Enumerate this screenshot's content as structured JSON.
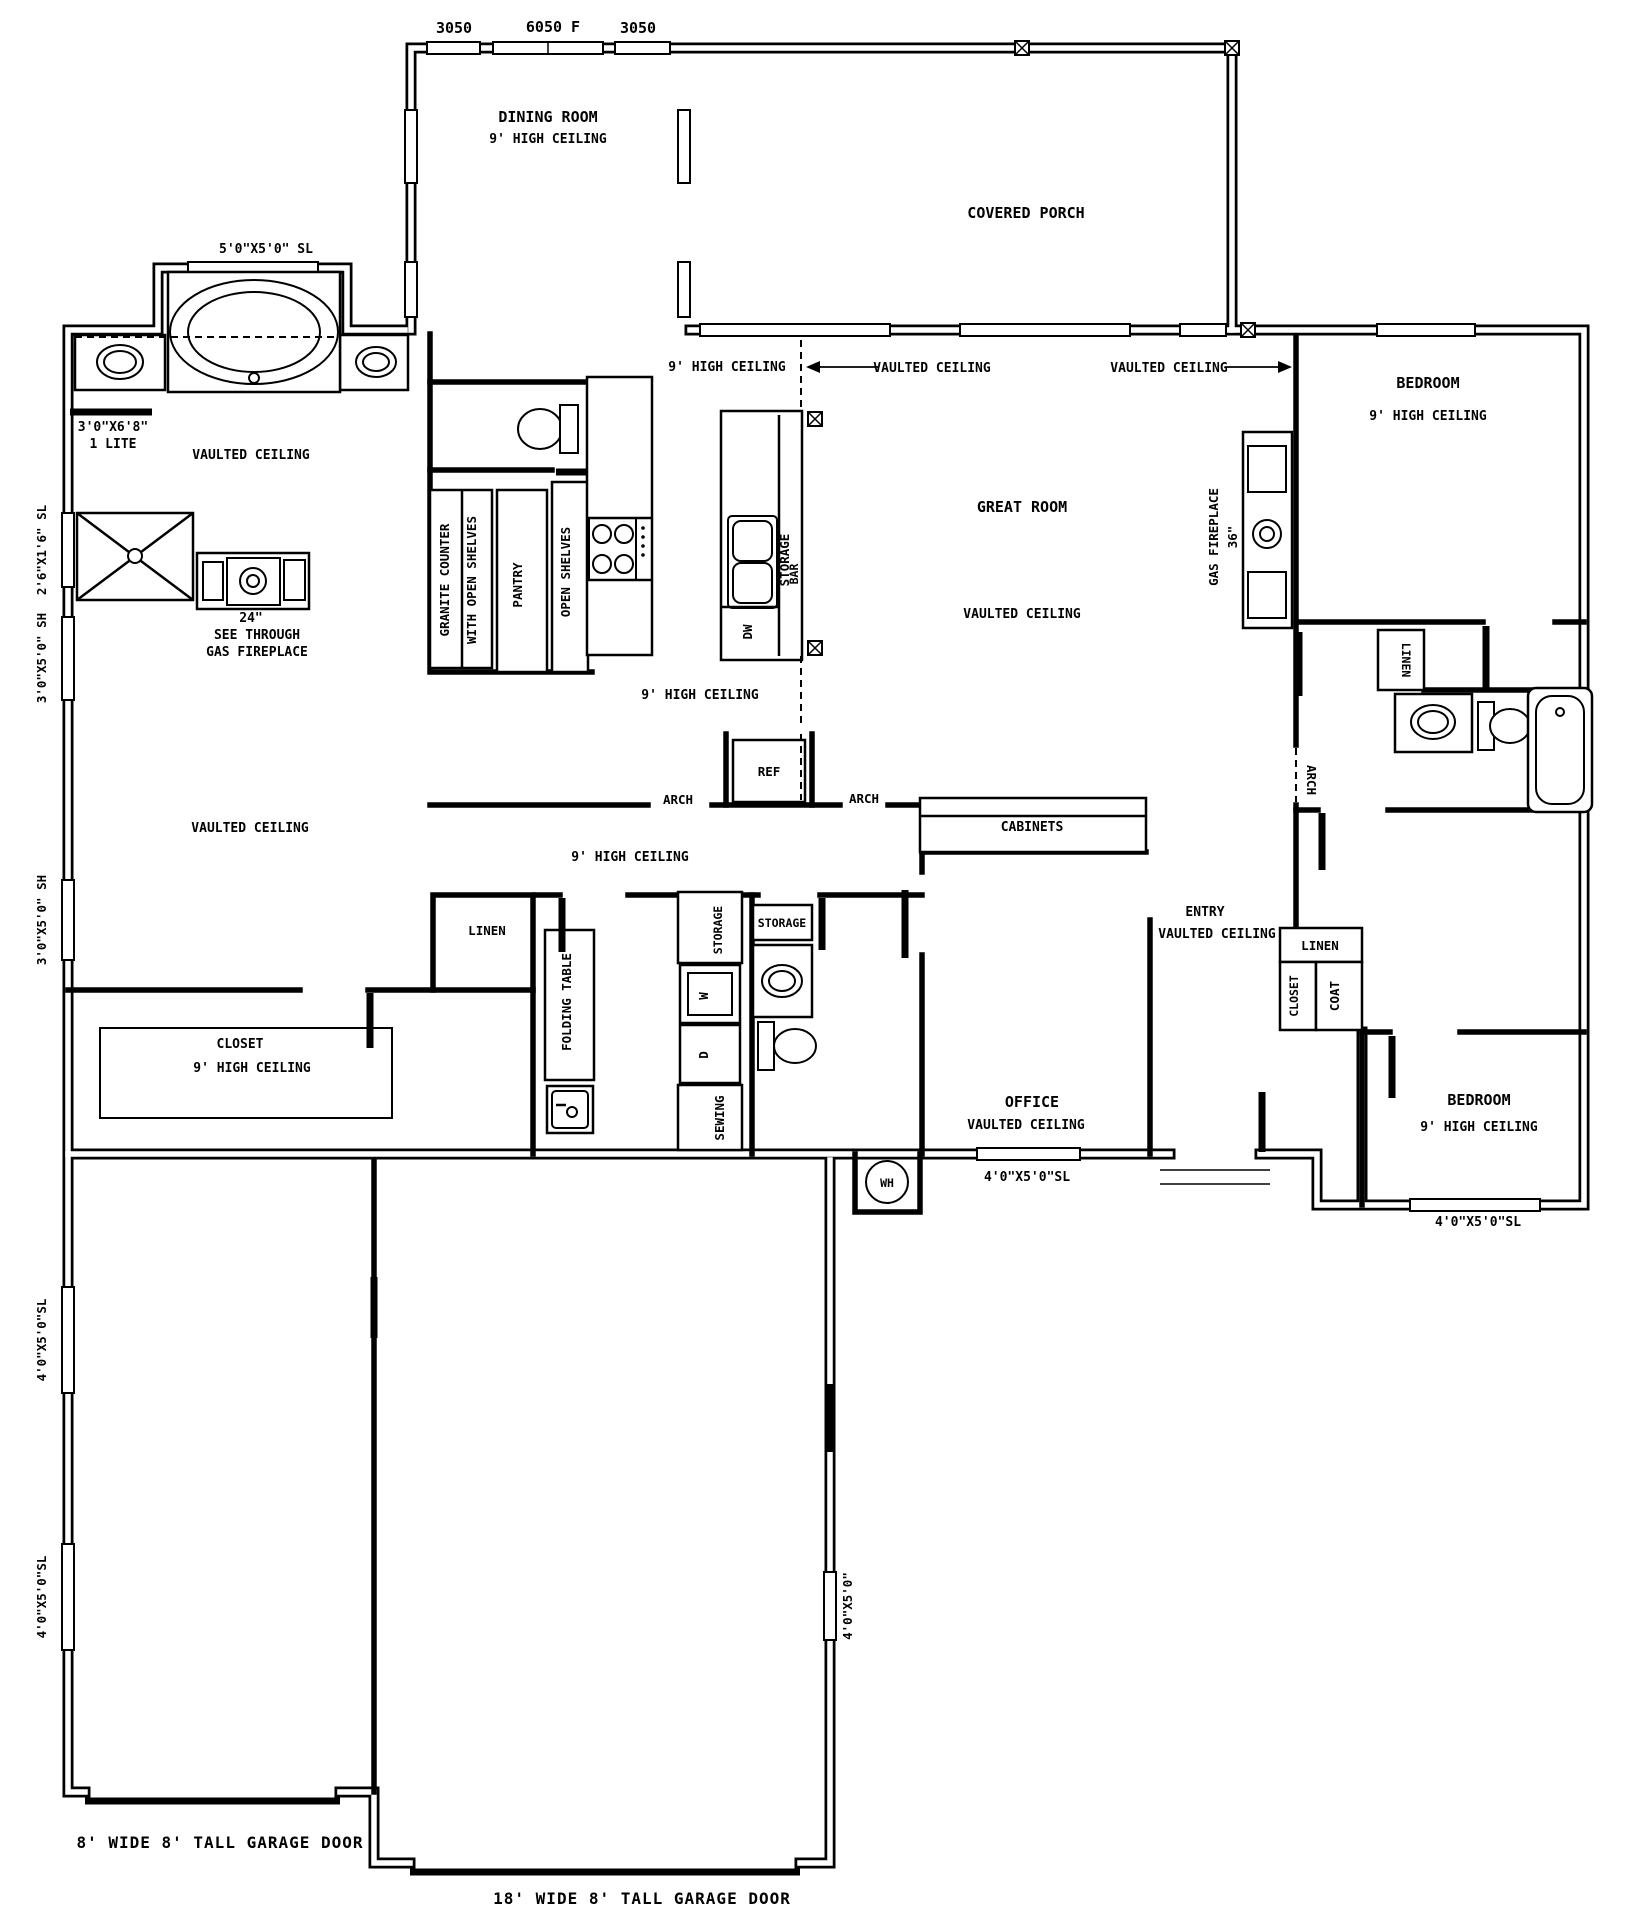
{
  "colors": {
    "line": "#000000",
    "background": "#ffffff"
  },
  "dims": {
    "left": "3050",
    "center": "6050 F",
    "right": "3050"
  },
  "dining": {
    "name": "DINING ROOM",
    "ceiling": "9' HIGH CEILING"
  },
  "porch": {
    "name": "COVERED PORCH"
  },
  "ceiling_notes": {
    "nine_main": "9' HIGH CEILING",
    "vaulted_left": "VAULTED CEILING",
    "vaulted_right": "VAULTED CEILING"
  },
  "master": {
    "window_top": "5'0\"X5'0\" SL",
    "door": "3'0\"X6'8\"",
    "door_lite": "1 LITE",
    "vaulted_bath": "VAULTED CEILING",
    "vaulted_bed": "VAULTED CEILING",
    "win_shower": "2'6\"X1'6\" SL",
    "win_sh1": "3'0\"X5'0\" SH",
    "win_sh2": "3'0\"X5'0\" SH",
    "fp_size": "24\"",
    "fp_line1": "SEE THROUGH",
    "fp_line2": "GAS FIREPLACE"
  },
  "kitchen": {
    "granite": "GRANITE COUNTER",
    "granite2": "WITH OPEN SHELVES",
    "pantry": "PANTRY",
    "open_shelves": "OPEN SHELVES",
    "ceiling": "9' HIGH CEILING",
    "island_storage": "STORAGE",
    "island_bar": "BAR",
    "dw": "DW",
    "ref": "REF",
    "arch_left": "ARCH",
    "arch_right": "ARCH"
  },
  "great_room": {
    "name": "GREAT ROOM",
    "vaulted": "VAULTED CEILING",
    "fp": "GAS FIREPLACE",
    "fp_size": "36\""
  },
  "bedroom1": {
    "name": "BEDROOM",
    "ceiling": "9' HIGH CEILING",
    "linen": "LINEN"
  },
  "bath2": {
    "arch": "ARCH"
  },
  "hall": {
    "ceiling": "9' HIGH CEILING",
    "linen": "LINEN"
  },
  "laundry": {
    "folding_table": "FOLDING TABLE",
    "storage": "STORAGE",
    "washer": "W",
    "dryer": "D",
    "sewing": "SEWING"
  },
  "half_bath": {
    "storage": "STORAGE"
  },
  "entry": {
    "name": "ENTRY",
    "vaulted": "VAULTED CEILING",
    "cabinets": "CABINETS",
    "linen": "LINEN",
    "closet": "CLOSET",
    "coat": "COAT"
  },
  "office": {
    "name": "OFFICE",
    "vaulted": "VAULTED CEILING",
    "window": "4'0\"X5'0\"SL"
  },
  "closet": {
    "name": "CLOSET",
    "ceiling": "9' HIGH CEILING"
  },
  "bedroom2": {
    "name": "BEDROOM",
    "ceiling": "9' HIGH CEILING",
    "window": "4'0\"X5'0\"SL"
  },
  "utility": {
    "wh": "WH"
  },
  "garage": {
    "door_small": "8' WIDE 8' TALL GARAGE DOOR",
    "door_large": "18' WIDE 8' TALL GARAGE DOOR",
    "win1": "4'0\"X5'0\"SL",
    "win2": "4'0\"X5'0\"SL",
    "win_east": "4'0\"X5'0\""
  }
}
